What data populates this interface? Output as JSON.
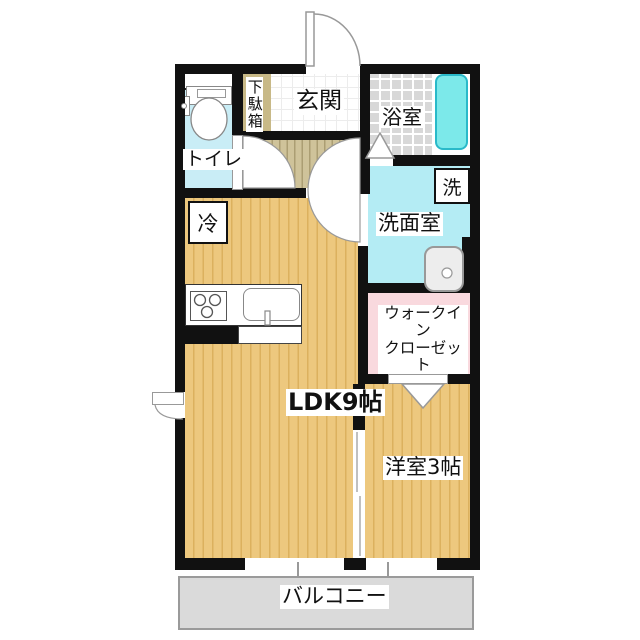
{
  "plan": {
    "type": "apartment-floorplan-1LDK",
    "rooms": {
      "entrance": "玄関",
      "shoe_cabinet": "下駄箱",
      "toilet": "トイレ",
      "bathroom": "浴室",
      "washroom": "洗面室",
      "washer": "洗",
      "refrigerator": "冷",
      "ldk": "LDK9帖",
      "walk_in_closet_line1": "ウォークイン",
      "walk_in_closet_line2": "クローゼット",
      "western_room": "洋室3帖",
      "balcony": "バルコニー"
    },
    "colors": {
      "wall": "#111111",
      "wood_floor": "#edc87e",
      "wood_stripe": "#dcb15e",
      "hall_floor": "#cfc39a",
      "toilet_floor": "#c9edf6",
      "washroom_floor": "#b4ecf4",
      "bathroom_floor": "#d8d8d8",
      "bathtub_fill": "#7ce9ea",
      "bathtub_border": "#29b9c9",
      "closet_floor": "#f9d9de",
      "balcony_floor": "#dadada",
      "shoe_cabinet": "#c8b987"
    }
  }
}
